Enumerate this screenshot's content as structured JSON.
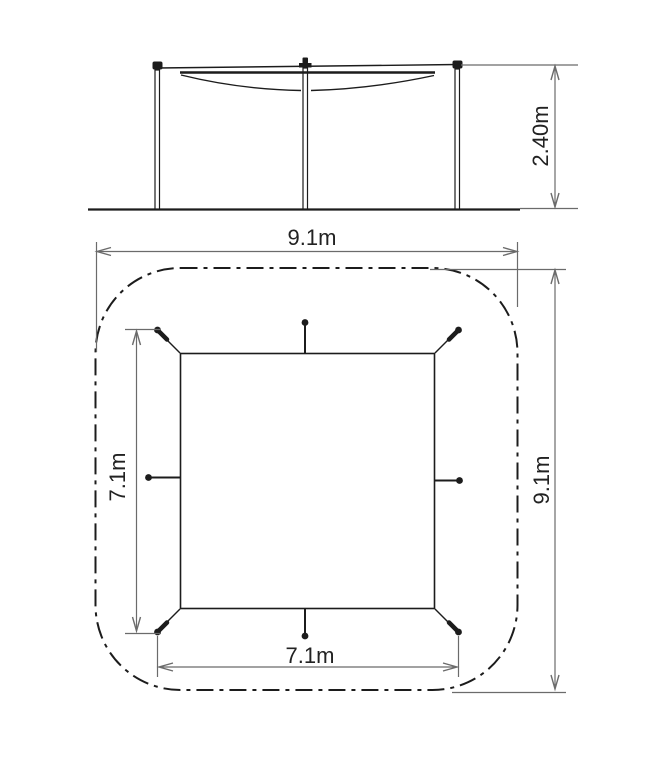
{
  "diagram": {
    "type": "technical-drawing",
    "subject": "shade-sail-canopy-dimensions",
    "views": {
      "elevation": {
        "name": "side-elevation",
        "height_dim": "2.40m"
      },
      "plan": {
        "name": "plan-view",
        "outer_width_dim": "9.1m",
        "outer_depth_dim": "9.1m",
        "canopy_width_dim": "7.1m",
        "canopy_depth_dim": "7.1m"
      }
    },
    "colors": {
      "background": "#ffffff",
      "drawing": "#1c1c1c",
      "dimension": "#6b6b6b"
    }
  }
}
